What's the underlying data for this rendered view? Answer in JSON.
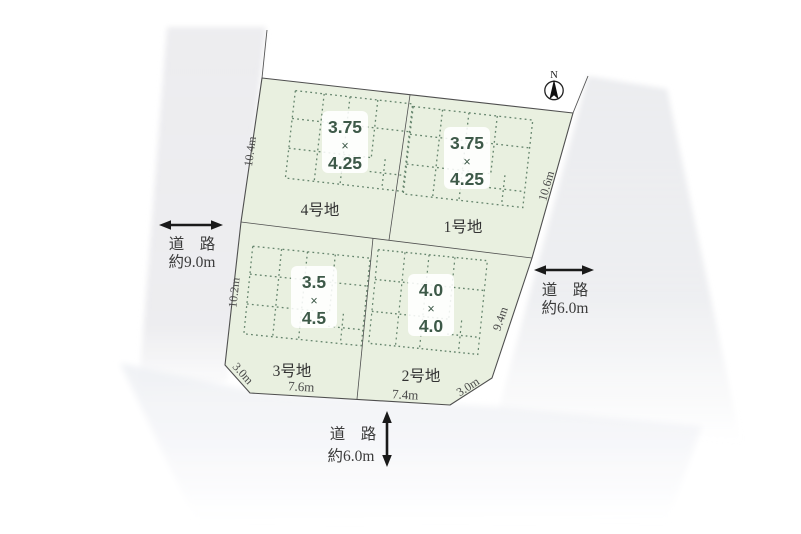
{
  "compass": {
    "label": "N"
  },
  "plots": [
    {
      "name": "4号地",
      "dim_w": "3.75",
      "dim_sep": "×",
      "dim_h": "4.25"
    },
    {
      "name": "1号地",
      "dim_w": "3.75",
      "dim_sep": "×",
      "dim_h": "4.25"
    },
    {
      "name": "3号地",
      "dim_w": "3.5",
      "dim_sep": "×",
      "dim_h": "4.5"
    },
    {
      "name": "2号地",
      "dim_w": "4.0",
      "dim_sep": "×",
      "dim_h": "4.0"
    }
  ],
  "edges": {
    "left_upper": "10.4m",
    "left_lower": "10.2m",
    "right_upper": "10.6m",
    "right_lower": "9.4m",
    "corner_bottom_left": "3.0m",
    "bottom_left": "7.6m",
    "bottom_right": "7.4m",
    "corner_bottom_right": "3.0m"
  },
  "roads": {
    "left": {
      "title": "道　路",
      "width": "約9.0m"
    },
    "right": {
      "title": "道　路",
      "width": "約6.0m"
    },
    "bottom": {
      "title": "道　路",
      "width": "約6.0m"
    }
  },
  "colors": {
    "plot_fill": "#e9f0e0",
    "grid_dot": "#5d7d65",
    "outline": "#4f4f4f",
    "road_band": "#edeef1",
    "dim_text": "#3d5948",
    "label_text": "#3b3b3b"
  }
}
